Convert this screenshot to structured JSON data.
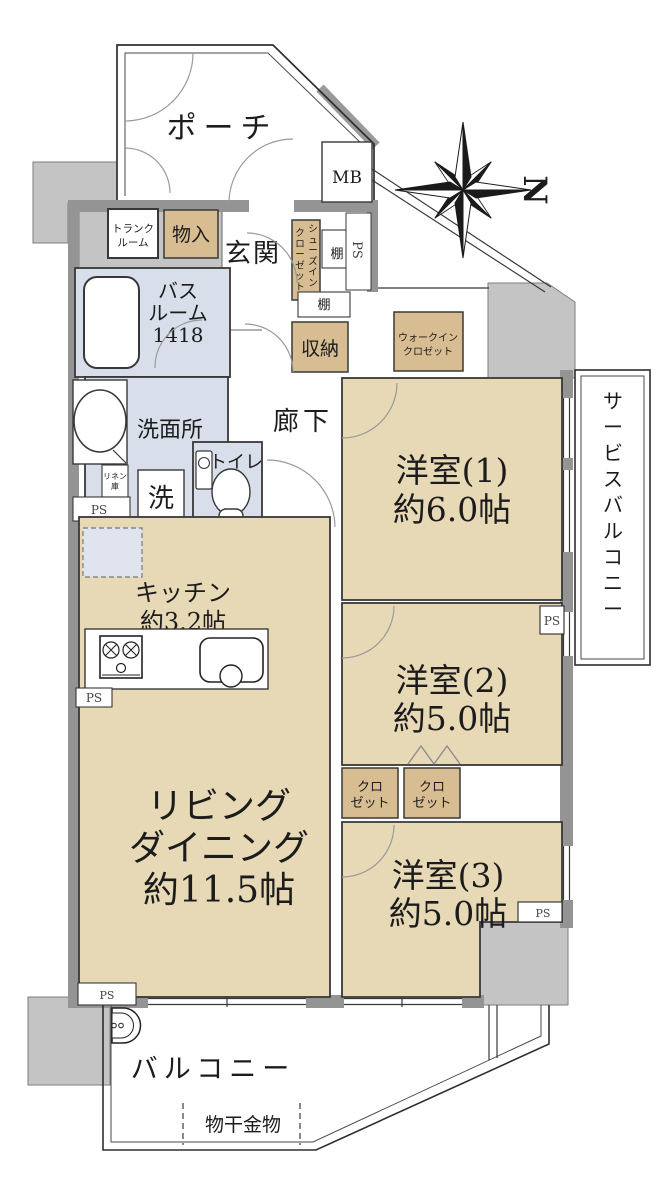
{
  "compass": {
    "north_label": "N"
  },
  "rooms": {
    "porch": {
      "label": "ポーチ"
    },
    "mb": {
      "label": "MB"
    },
    "trunk": {
      "line1": "トランク",
      "line2": "ルーム"
    },
    "monoire": {
      "label": "物入"
    },
    "genkan": {
      "label": "玄関"
    },
    "shoes_closet": {
      "line1": "シューズイン",
      "line2": "クローゼット"
    },
    "shelf_top": {
      "label": "棚"
    },
    "shelf_bottom": {
      "label": "棚"
    },
    "ps_entrance": {
      "label": "PS"
    },
    "bathroom": {
      "line1": "バス",
      "line2": "ルーム",
      "line3": "1418"
    },
    "storage": {
      "label": "収納"
    },
    "walk_in_closet": {
      "line1": "ウォークイン",
      "line2": "クロゼット"
    },
    "washroom": {
      "label": "洗面所"
    },
    "hallway": {
      "label": "廊下"
    },
    "bedroom1": {
      "name": "洋室(1)",
      "size": "約6.0帖"
    },
    "service_balcony": {
      "label": "サービスバルコニー"
    },
    "linen": {
      "line1": "リネン",
      "line2": "庫"
    },
    "ps_linen": {
      "label": "PS"
    },
    "washer": {
      "label": "洗"
    },
    "toilet": {
      "label": "トイレ"
    },
    "pantry": {
      "label": "食品庫"
    },
    "kitchen": {
      "name": "キッチン",
      "size": "約3.2帖"
    },
    "ps_kitchen": {
      "label": "PS"
    },
    "bedroom2": {
      "name": "洋室(2)",
      "size": "約5.0帖"
    },
    "ps_bedroom2": {
      "label": "PS"
    },
    "closet_left": {
      "line1": "クロ",
      "line2": "ゼット"
    },
    "closet_right": {
      "line1": "クロ",
      "line2": "ゼット"
    },
    "living": {
      "line1": "リビング",
      "line2": "ダイニング",
      "line3": "約11.5帖"
    },
    "bedroom3": {
      "name": "洋室(3)",
      "size": "約5.0帖"
    },
    "ps_bedroom3": {
      "label": "PS"
    },
    "ps_living": {
      "label": "PS"
    },
    "balcony": {
      "label": "バルコニー"
    },
    "laundry_hardware": {
      "label": "物干金物"
    }
  },
  "colors": {
    "room_fill": "#e7d9b6",
    "closet_fill": "#d8bd92",
    "wet_area_fill": "#d8deea",
    "exterior_gray": "#c4c4c4",
    "wall_gray": "#949494"
  }
}
